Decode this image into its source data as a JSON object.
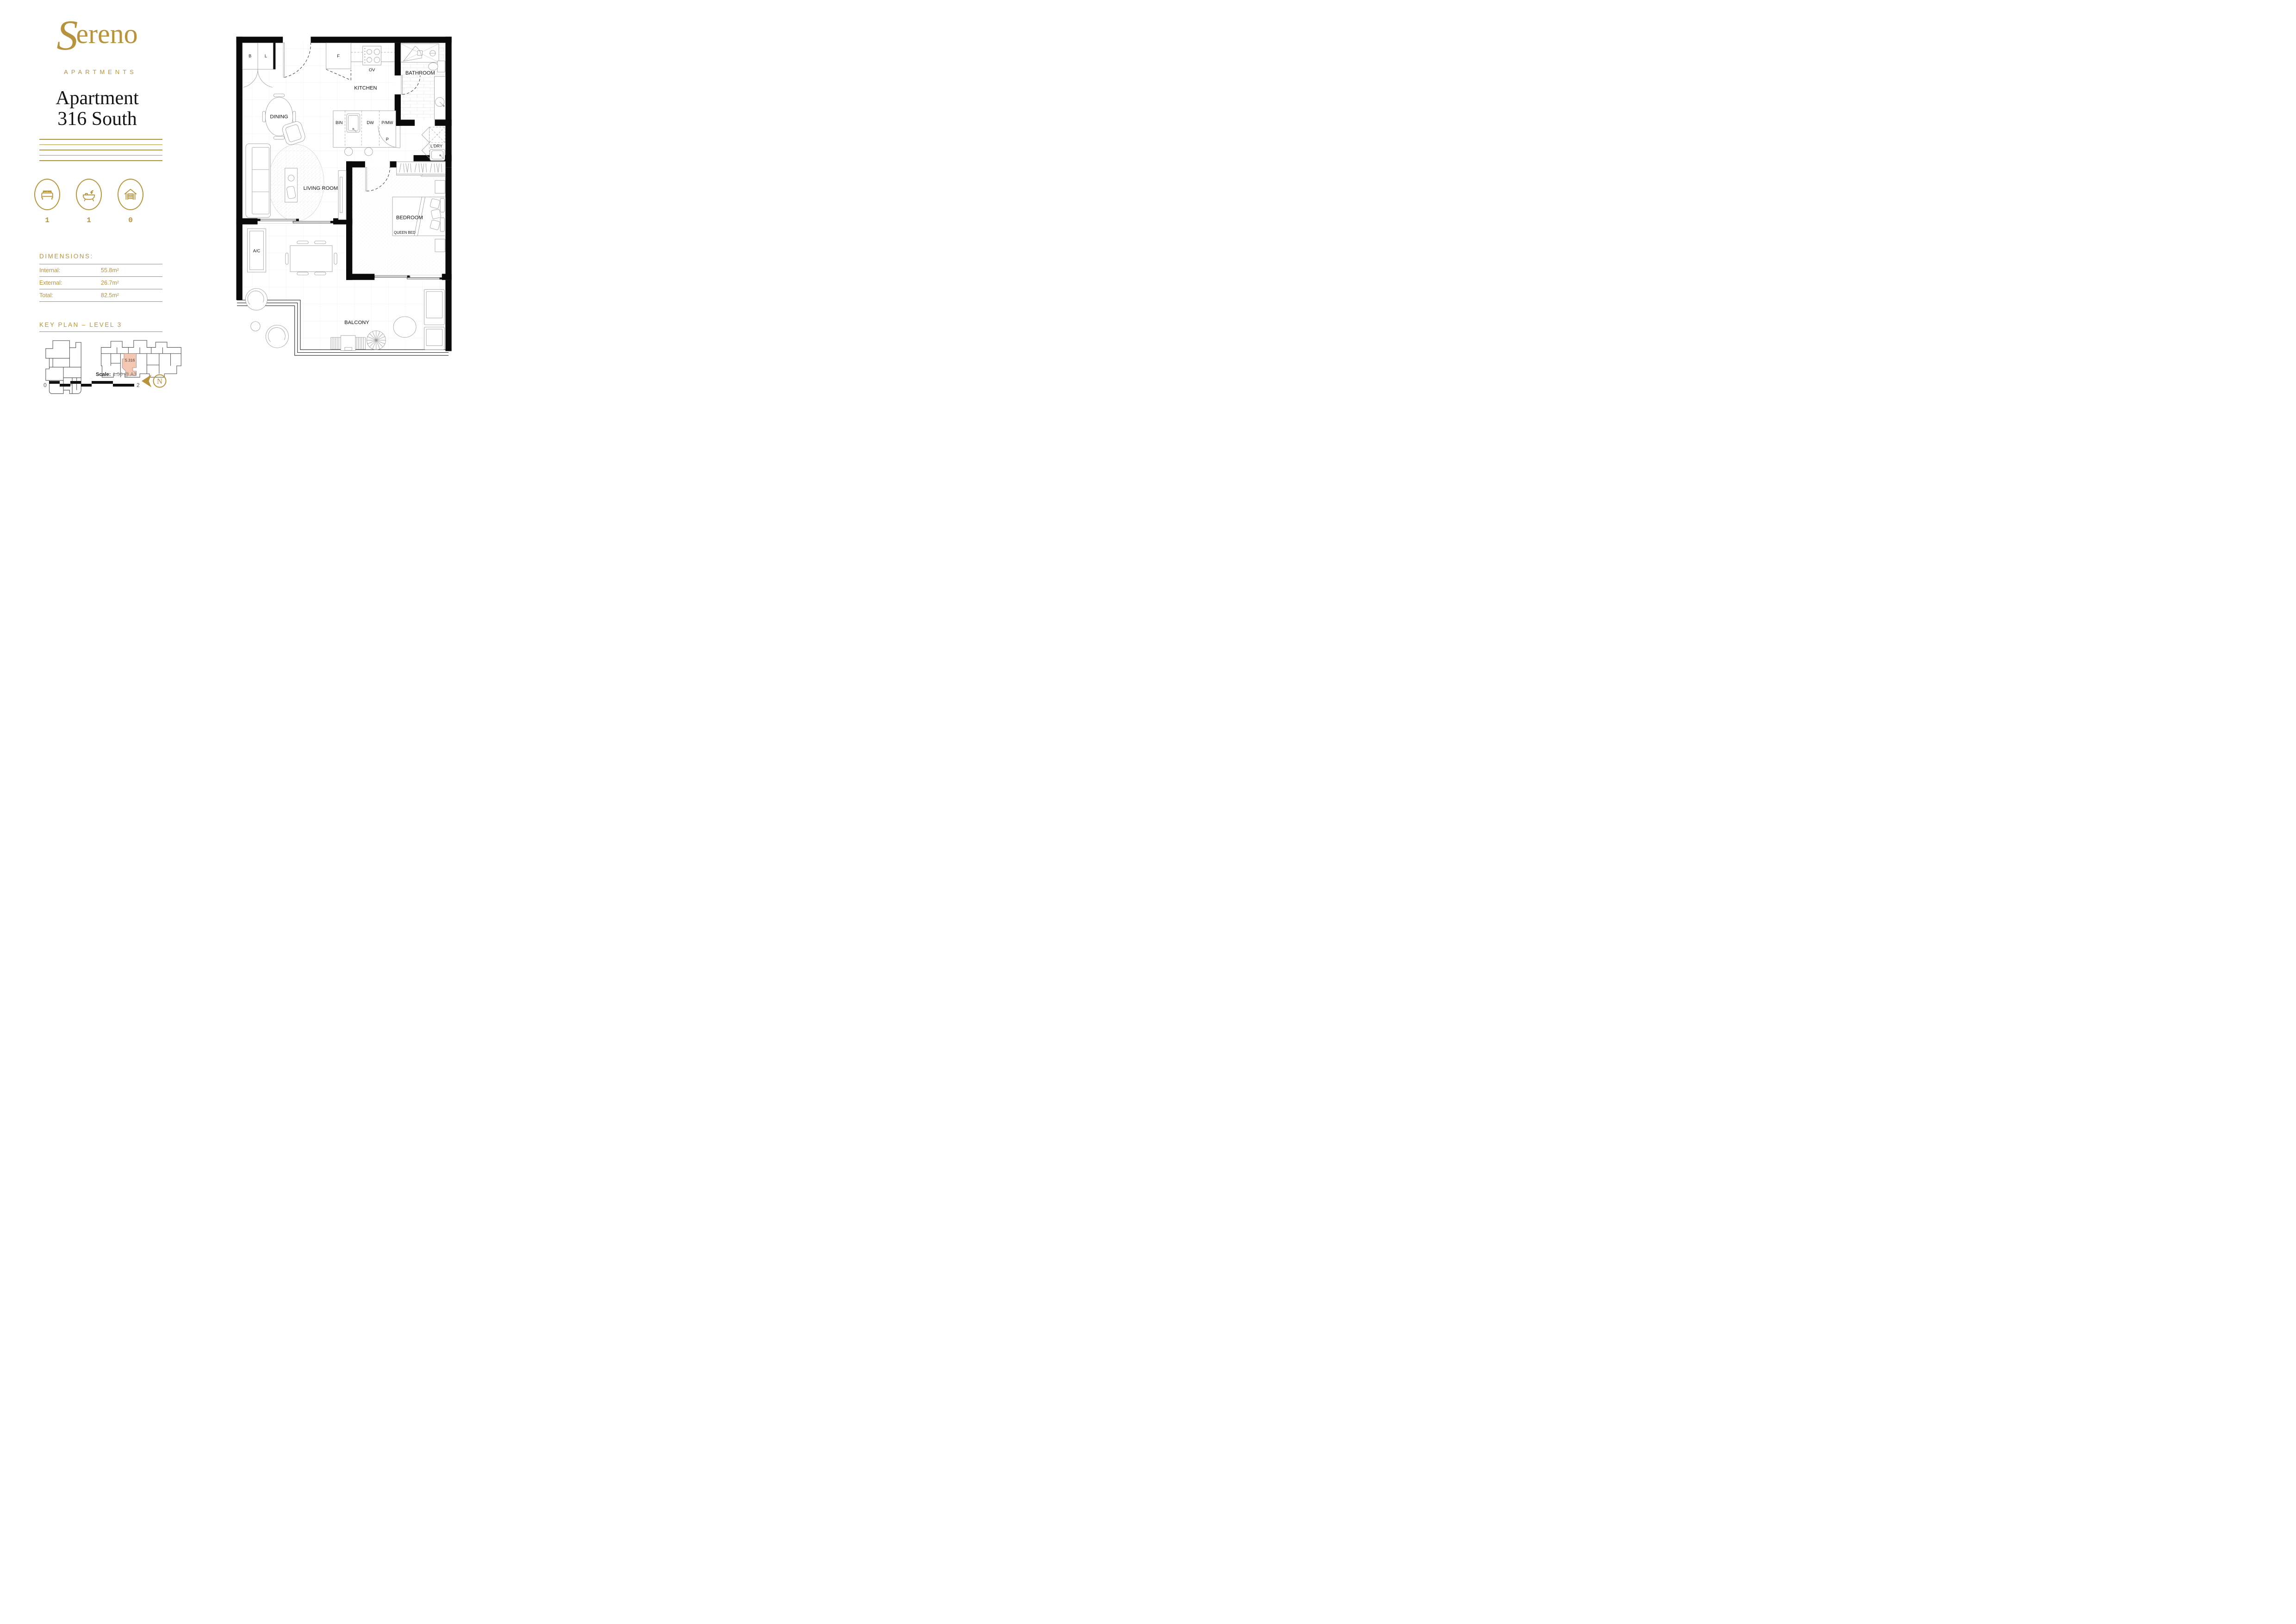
{
  "brand": {
    "name": "Sereno",
    "tagline": "APARTMENTS"
  },
  "heading": {
    "line1": "Apartment",
    "line2": "316 South"
  },
  "stats": [
    {
      "icon": "bed-icon",
      "value": "1"
    },
    {
      "icon": "bath-icon",
      "value": "1"
    },
    {
      "icon": "garage-icon",
      "value": "0"
    }
  ],
  "dimensions": {
    "heading": "DIMENSIONS:",
    "rows": [
      {
        "label": "Internal:",
        "value": "55.8m²"
      },
      {
        "label": "External:",
        "value": "26.7m²"
      },
      {
        "label": "Total:",
        "value": "82.5m²"
      }
    ]
  },
  "key_plan": {
    "heading": "KEY PLAN – LEVEL 3",
    "highlighted_unit": "S.316"
  },
  "floor_plan": {
    "rooms": {
      "kitchen": "KITCHEN",
      "dining": "DINING",
      "living": "LIVING ROOM",
      "bathroom": "BATHROOM",
      "laundry": "L'DRY",
      "bedroom": "BEDROOM",
      "queen_bed": "QUEEN BED",
      "balcony": "BALCONY"
    },
    "fixtures": {
      "broom": "B",
      "linen": "L",
      "fridge": "F",
      "oven": "OV",
      "bin": "BIN",
      "dishwasher": "DW",
      "pantry_microwave": "P/MW",
      "pantry": "P",
      "ac": "A/C"
    }
  },
  "scale": {
    "label": "Scale:",
    "value": "1:50  @ A3",
    "bar_start": "0",
    "bar_end": "2"
  },
  "compass": {
    "label": "N"
  },
  "colors": {
    "gold": "#b6933c",
    "salmon": "#f5c6b0",
    "wall": "#0a0a0a"
  }
}
